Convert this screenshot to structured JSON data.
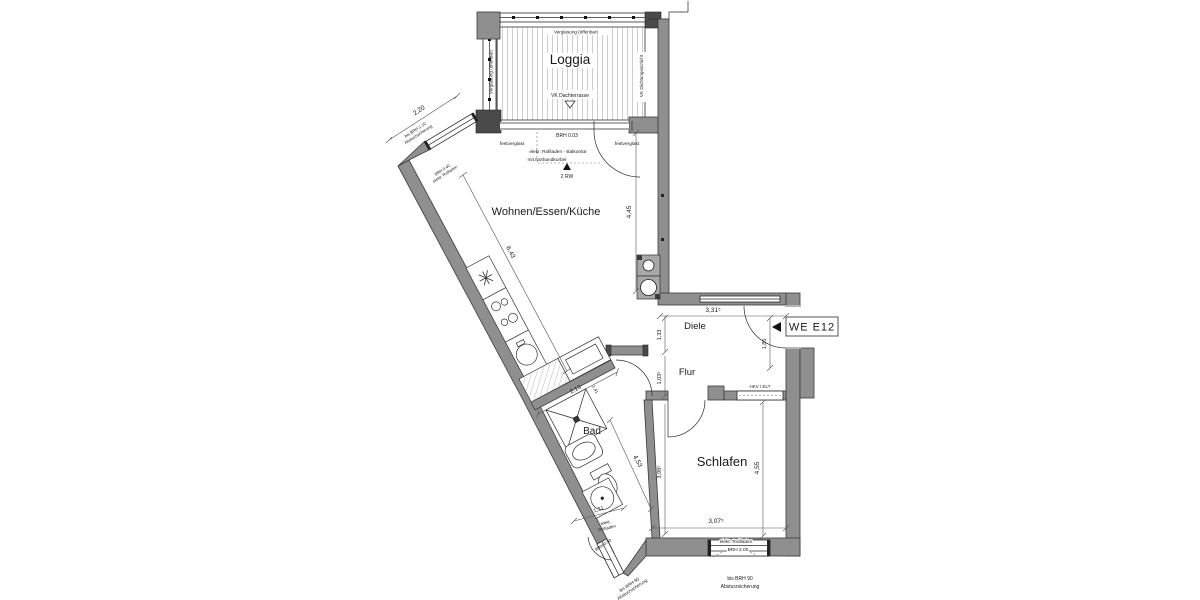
{
  "unit": {
    "label": "WE E12"
  },
  "rooms": {
    "loggia": "Loggia",
    "wohnen": "Wohnen/Essen/Küche",
    "diele": "Diele",
    "flur": "Flur",
    "bad": "Bad",
    "schlafen": "Schlafen"
  },
  "dims": {
    "d220": "2,20",
    "d643": "6,43",
    "d445": "4,45",
    "d3315": "3,31⁵",
    "d133": "1,33",
    "d185": "1,85",
    "d1035": "1,03⁵",
    "d213": "2,13",
    "d453": "4,53",
    "d141": "1,41",
    "d131": "1,31",
    "d3985": "3,98⁵",
    "d455": "4,55",
    "d3075": "3,07⁵"
  },
  "loggia_notes": {
    "top": "Verglasung (öffenbar)",
    "left": "Verglasung (öffenbar)",
    "right": "VK Dichtungsschicht",
    "bottom": "VK Dachterrasse"
  },
  "facade": {
    "brh": "BRH 0.03",
    "fest_left": "festverglast",
    "fest_right": "festverglast",
    "rollladen": "elekr. Rollladen - Balkontür",
    "kurbel": "mit Nothandkurbel",
    "rw": "2 RW"
  },
  "left_window": {
    "sich1": "bis BRH 1.10",
    "sich2": "Absturzsicherung",
    "brh": "BRH 0.40",
    "rollladen": "elektr. Rollladen"
  },
  "flur_notes": {
    "hkv": "HKV / ELT"
  },
  "bad_win": {
    "roll1": "elekt.",
    "roll2": "Rollladen",
    "brh": "BRH 0.90",
    "sich1": "bis BRH 90",
    "sich2": "Absturzsicherung"
  },
  "schlafen_win": {
    "roll": "elekt. Rollladen",
    "brh": "BRH 2.00",
    "sich1": "bis BRH 90",
    "sich2": "Absturzsicherung"
  },
  "colors": {
    "wall": "#8f8f8f",
    "wall_dark": "#4a4a4a",
    "line": "#1a1a1a",
    "hatch": "#c9c9c9"
  }
}
